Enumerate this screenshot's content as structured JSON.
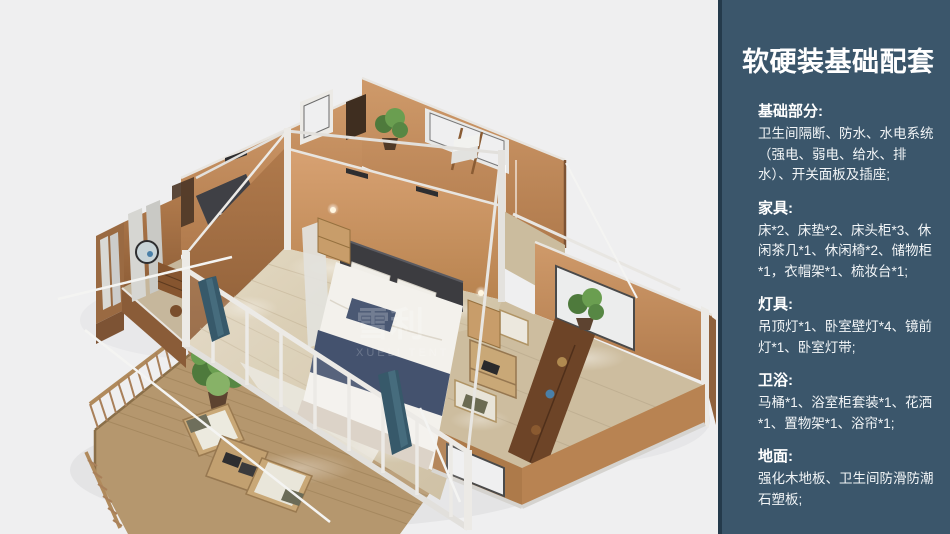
{
  "page": {
    "background": "#efeff0"
  },
  "panel": {
    "background": "#3b566b",
    "edge_color": "#243a4b",
    "text_color": "#ffffff",
    "title": "软硬装基础配套",
    "sections": [
      {
        "heading": "基础部分:",
        "body": "卫生间隔断、防水、水电系统（强电、弱电、给水、排水）、开关面板及插座;"
      },
      {
        "heading": "家具:",
        "body": "床*2、床垫*2、床头柜*3、休闲茶几*1、休闲椅*2、储物柜*1，衣帽架*1、梳妆台*1;"
      },
      {
        "heading": "灯具:",
        "body": "吊顶灯*1、卧室壁灯*4、镜前灯*1、卧室灯带;"
      },
      {
        "heading": "卫浴:",
        "body": "马桶*1、浴室柜套装*1、花洒*1、置物架*1、浴帘*1;"
      },
      {
        "heading": "地面:",
        "body": "强化木地板、卫生间防滑防潮石塑板;"
      }
    ]
  },
  "illustration": {
    "watermark_cn": "雪利",
    "watermark_en": "XUELI TENT",
    "colors": {
      "wall_orange": "#c08a5c",
      "wall_shadow": "#96673f",
      "floor_wood": "#d2c3a8",
      "deck_wood": "#b5976e",
      "frame_white": "#eceae6",
      "bed_navy": "#44526e",
      "curtain_teal": "#37596a",
      "plant_green": "#5d8a46"
    }
  }
}
